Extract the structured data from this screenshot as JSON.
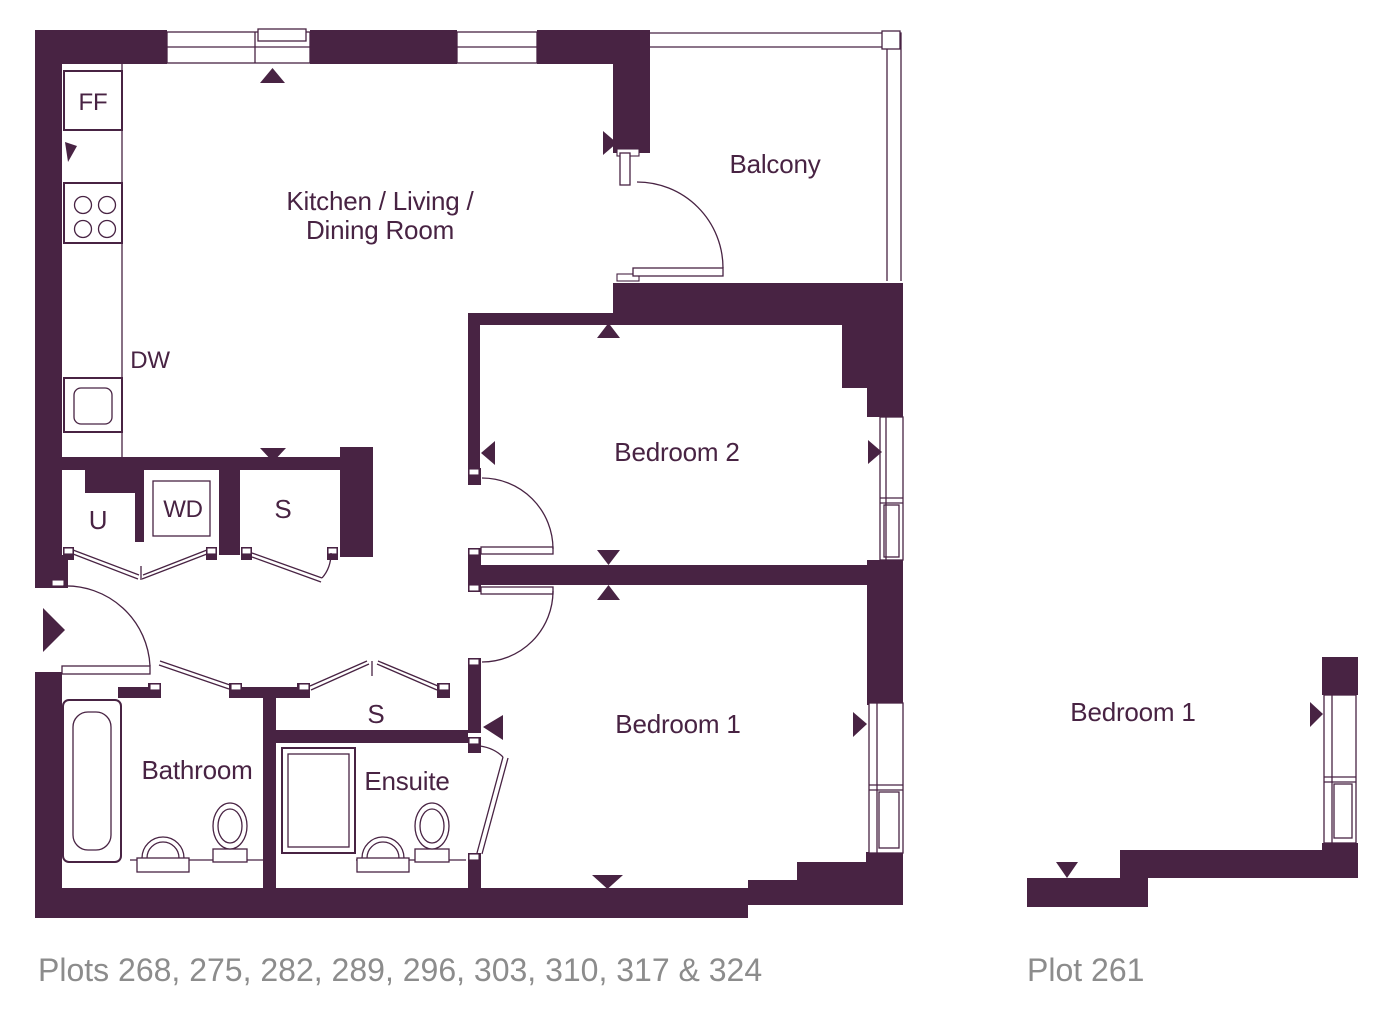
{
  "colors": {
    "wall": "#482343",
    "line": "#482343",
    "label": "#482343",
    "caption": "#8c8c8c",
    "background": "#ffffff"
  },
  "main_plan": {
    "caption": "Plots 268, 275, 282, 289, 296, 303, 310, 317 & 324",
    "rooms": {
      "kitchen_living_dining": {
        "label_line1": "Kitchen / Living /",
        "label_line2": "Dining Room"
      },
      "balcony": {
        "label": "Balcony"
      },
      "bedroom_2": {
        "label": "Bedroom 2"
      },
      "bedroom_1": {
        "label": "Bedroom 1"
      },
      "bathroom": {
        "label": "Bathroom"
      },
      "ensuite": {
        "label": "Ensuite"
      },
      "utility_cupboard": {
        "label": "U"
      },
      "storage_cupboard": {
        "label": "S"
      },
      "hall_storage_cupboard": {
        "label": "S"
      }
    },
    "appliances": {
      "fridge_freezer": {
        "label": "FF"
      },
      "dishwasher": {
        "label": "DW"
      },
      "washer_dryer": {
        "label": "WD"
      }
    }
  },
  "secondary_plan": {
    "caption": "Plot 261",
    "rooms": {
      "bedroom_1": {
        "label": "Bedroom 1"
      }
    }
  }
}
